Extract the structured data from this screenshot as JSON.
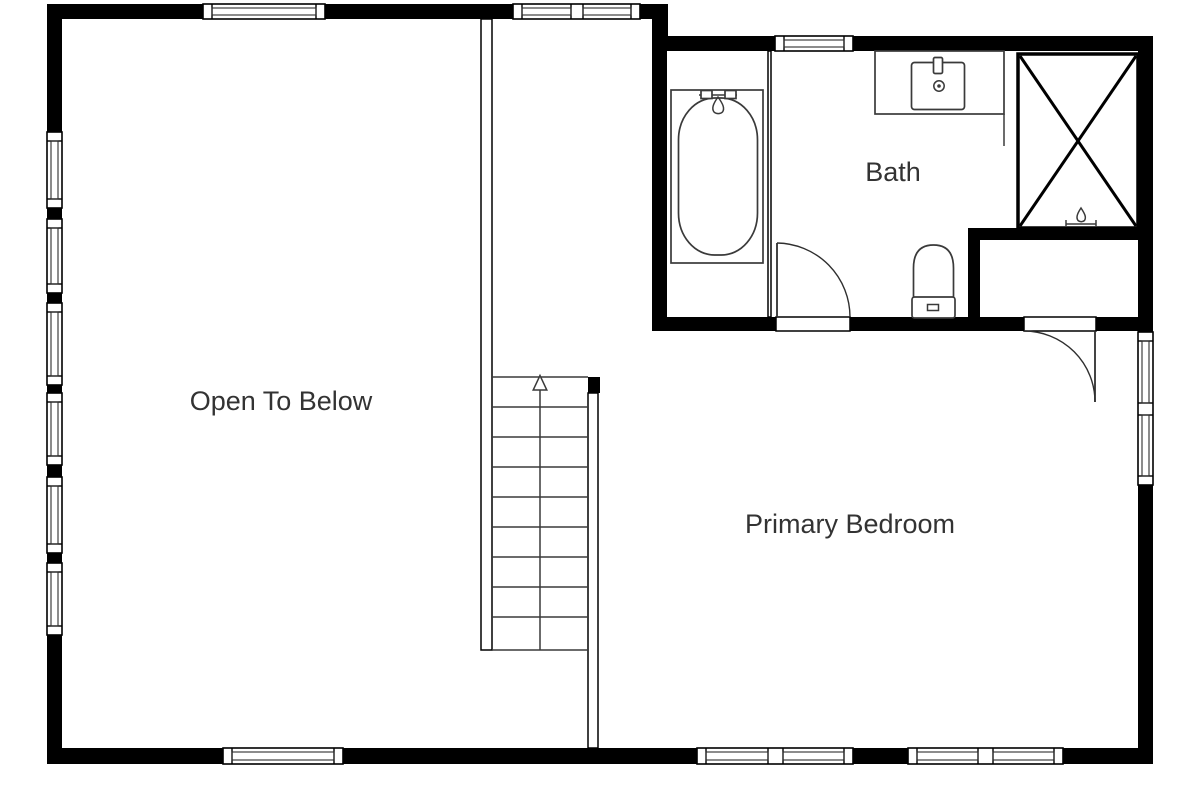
{
  "plan": {
    "type": "floor-plan-second-level",
    "background": "#ffffff"
  },
  "colors": {
    "wall": "#000000",
    "fixture_line": "#3a3a3a",
    "text": "#333333",
    "background": "#ffffff"
  },
  "rooms": [
    {
      "label": "Open To Below"
    },
    {
      "label": "Bath"
    },
    {
      "label": "Primary Bedroom"
    }
  ],
  "fixtures": [
    {
      "icon": "bathtub-icon"
    },
    {
      "icon": "vanity-sink-icon"
    },
    {
      "icon": "shower-icon"
    },
    {
      "icon": "toilet-icon"
    },
    {
      "icon": "stairs-up-arrow-icon"
    }
  ],
  "stairs": {
    "treads": 9,
    "direction": "up"
  },
  "counts": {
    "windows": 12,
    "doors": 2
  }
}
